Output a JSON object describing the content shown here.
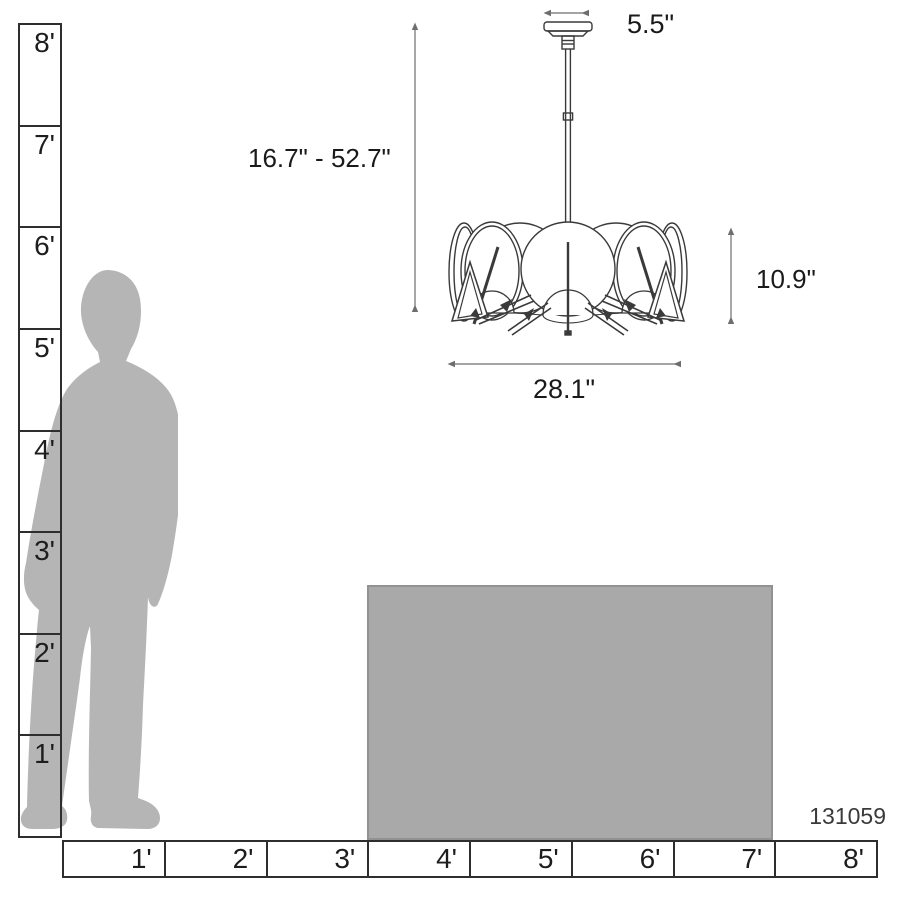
{
  "diagram": {
    "sku": "131059",
    "dims": {
      "canopy_width": "5.5\"",
      "height_range": "16.7\" - 52.7\"",
      "fixture_height": "10.9\"",
      "fixture_width": "28.1\""
    },
    "vertical_ruler_labels": [
      "8'",
      "7'",
      "6'",
      "5'",
      "4'",
      "3'",
      "2'",
      "1'"
    ],
    "horizontal_ruler_labels": [
      "1'",
      "2'",
      "3'",
      "4'",
      "5'",
      "6'",
      "7'",
      "8'"
    ],
    "colors": {
      "silhouette": "#b5b5b5",
      "table": "#a9a9a9",
      "ruler_line": "#2e2e2e",
      "drawing_line": "#3a3a3a",
      "dim_line": "#6e6e6e",
      "text": "#1f1f1f"
    }
  }
}
